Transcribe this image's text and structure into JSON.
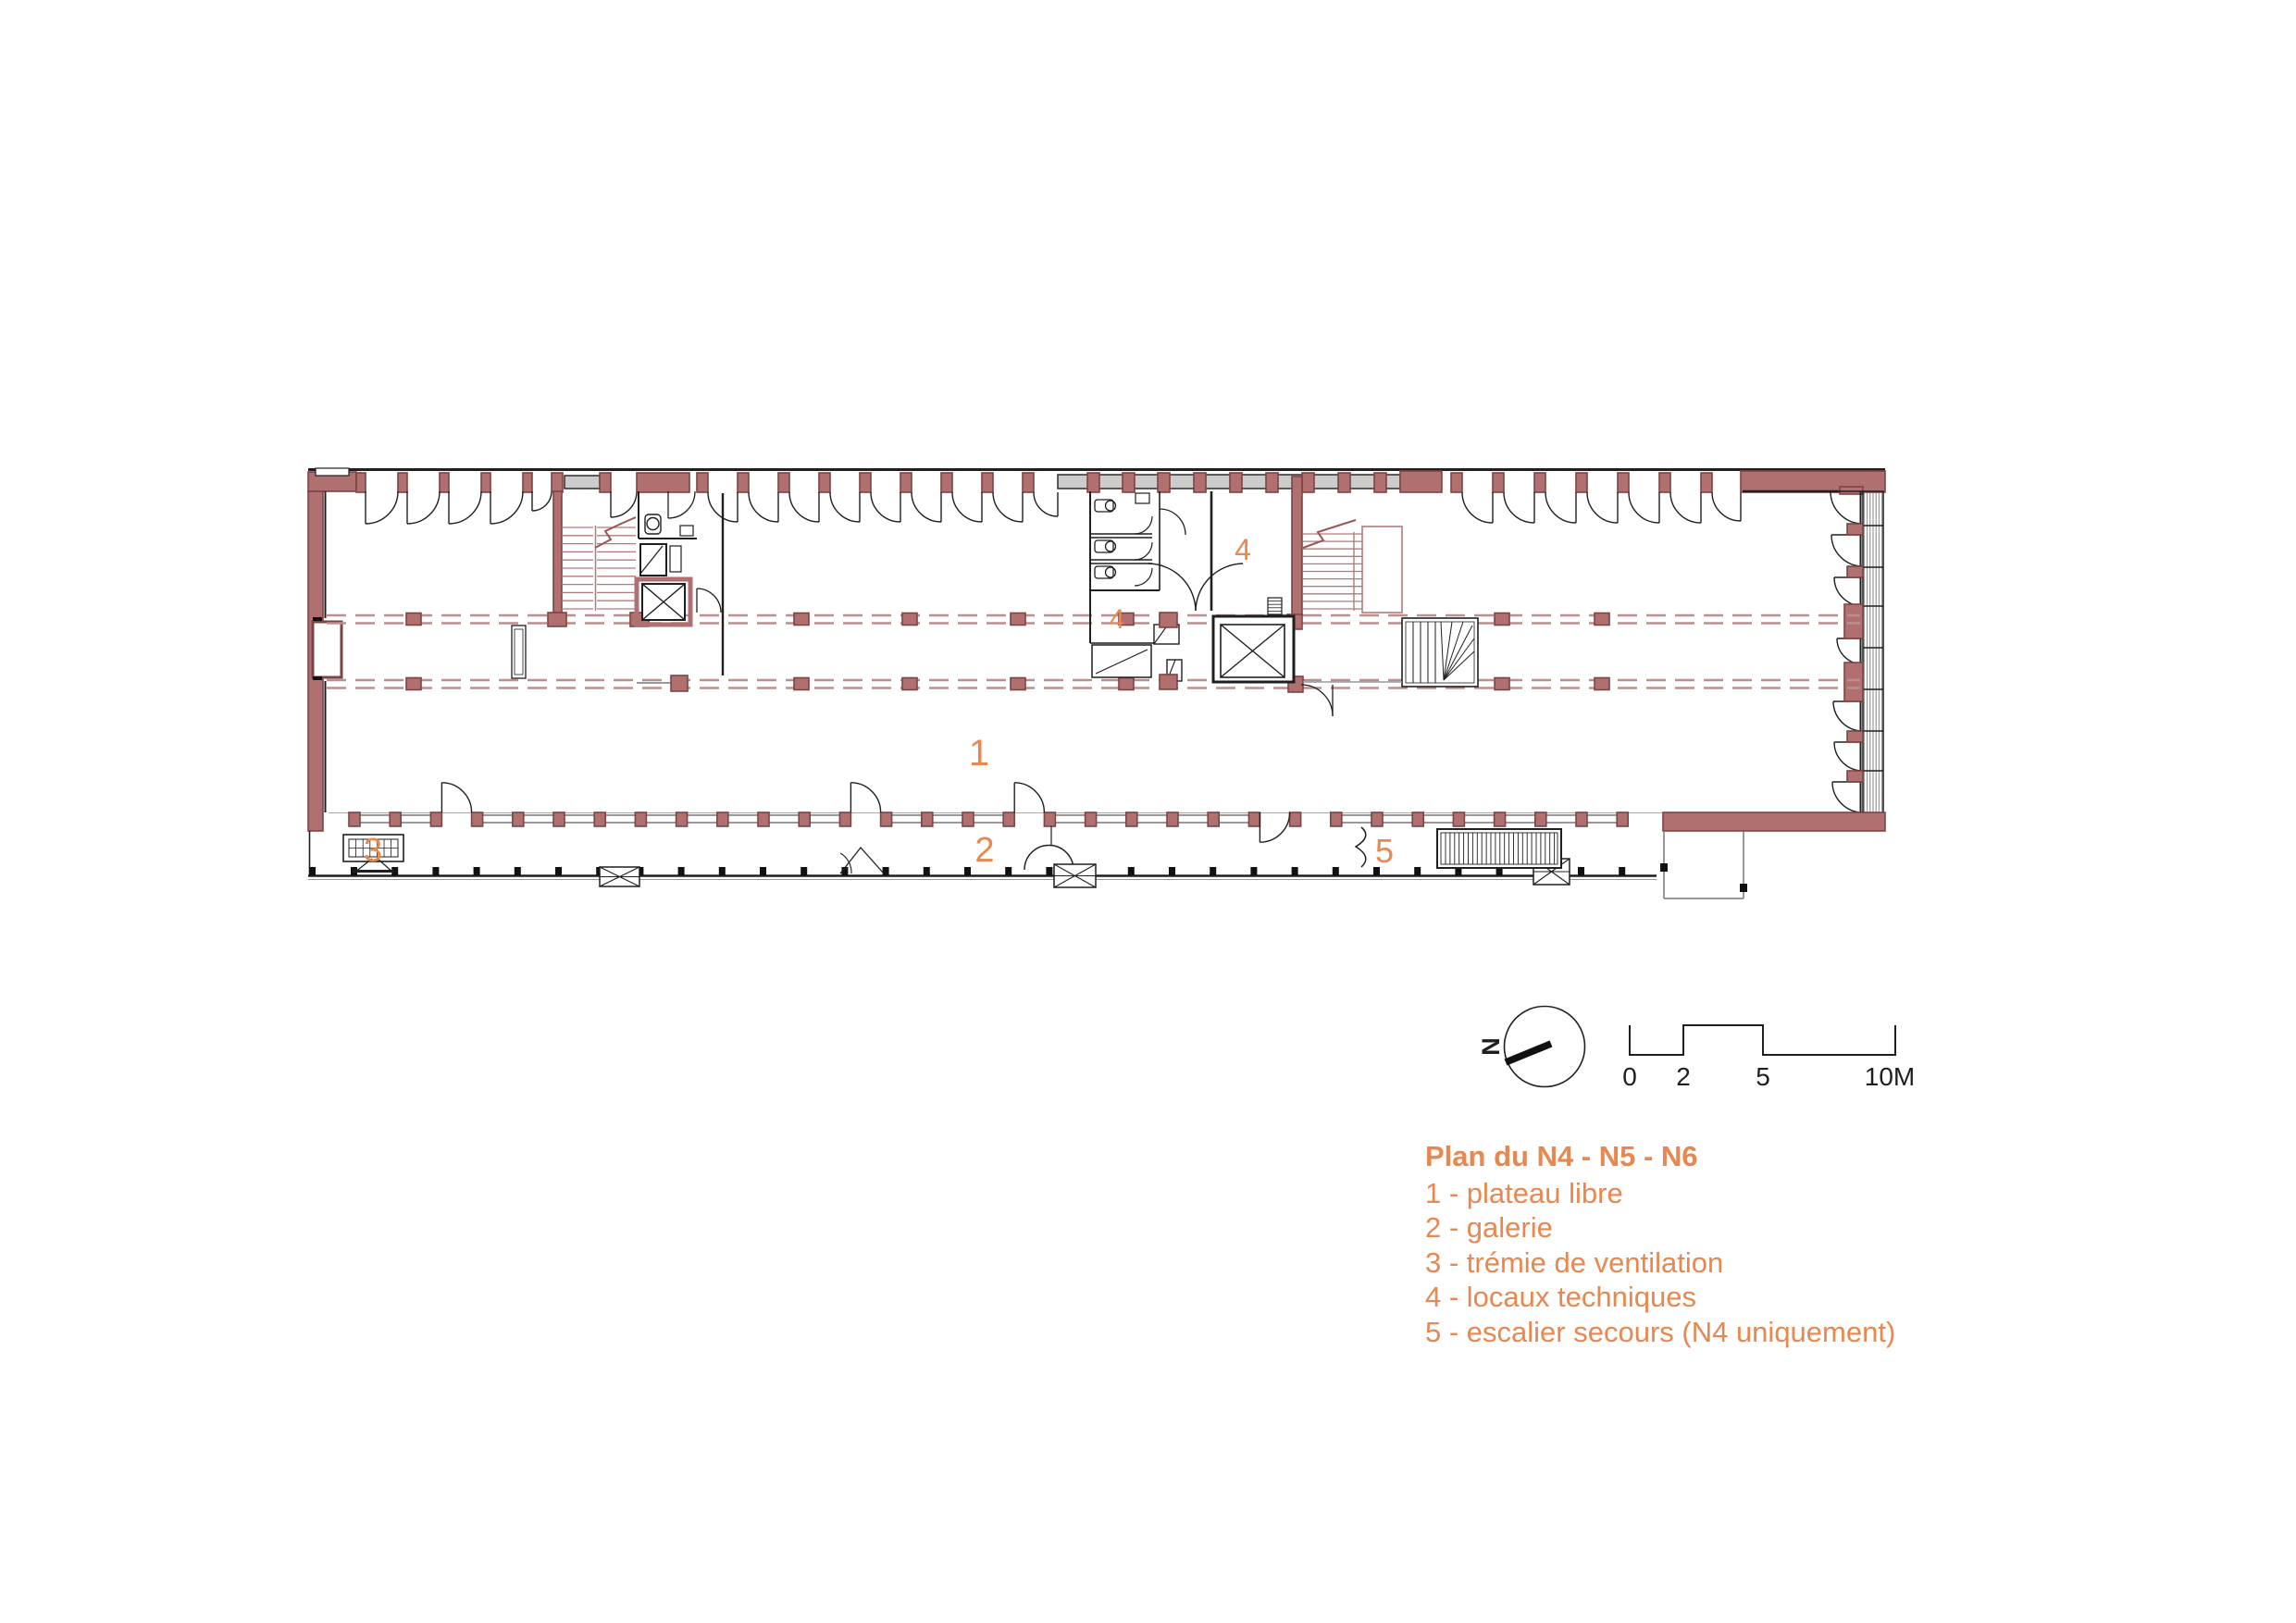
{
  "plan": {
    "area_labels": [
      {
        "text": "1"
      },
      {
        "text": "2"
      },
      {
        "text": "3"
      },
      {
        "text": "4"
      },
      {
        "text": "4"
      },
      {
        "text": "5"
      }
    ]
  },
  "north_arrow": {
    "label": "N"
  },
  "scale_bar": {
    "tick_labels": [
      "0",
      "2",
      "5",
      "10M"
    ]
  },
  "legend": {
    "title": "Plan du N4 - N5 - N6",
    "items": [
      "1 - plateau libre",
      "2 - galerie",
      "3 - trémie de ventilation",
      "4 - locaux techniques",
      "5 - escalier secours (N4 uniquement)"
    ]
  },
  "colors": {
    "accent_orange": "#E8874F",
    "wall_fill": "#B17070",
    "wall_stroke": "#7D4444",
    "dash_line": "#BC8F8F",
    "stair_line": "#B37A7A",
    "gray_infill": "#CCCCCC",
    "line_dark": "#1F1F1F"
  }
}
